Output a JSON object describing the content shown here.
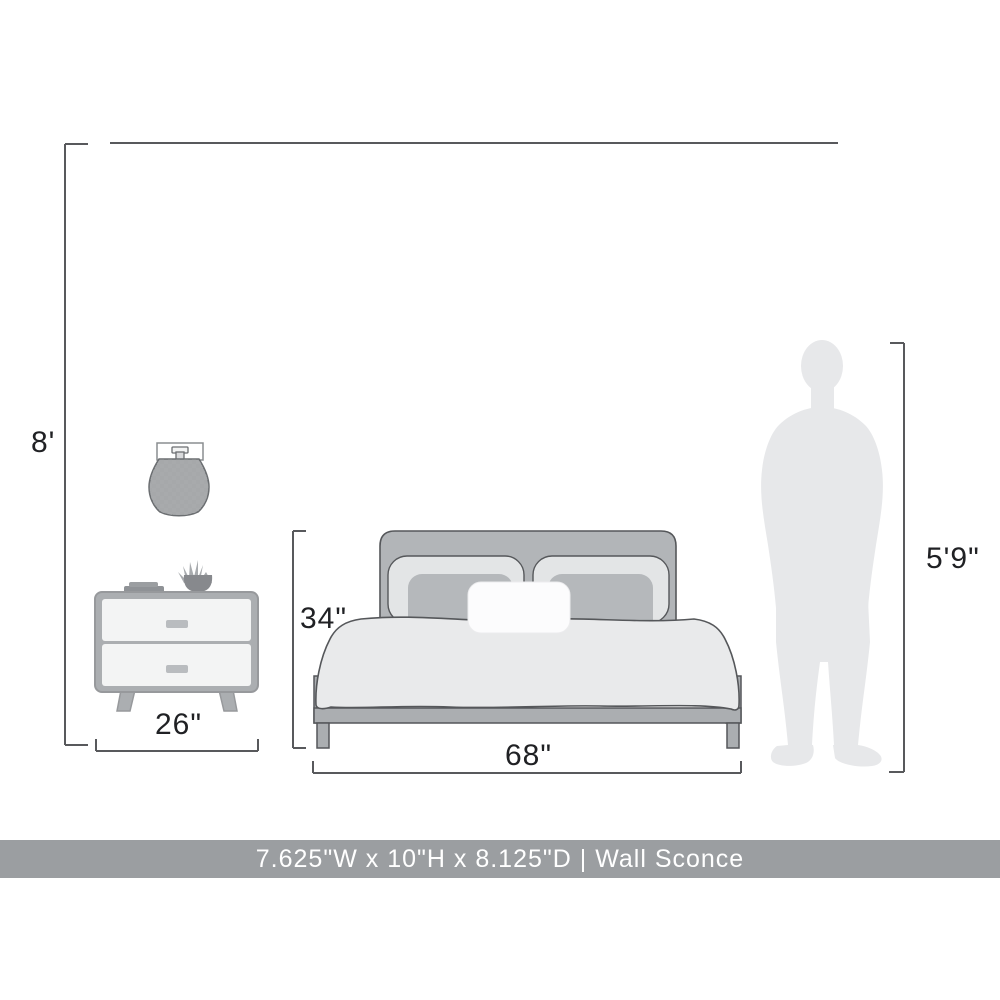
{
  "title": "Furniture scale dimension diagram",
  "labels": {
    "ceiling": "8'",
    "nightstand_width": "26\"",
    "bed_height": "34\"",
    "bed_width": "68\"",
    "person_height": "5'9\""
  },
  "banner": {
    "text": "7.625\"W x 10\"H x 8.125\"D | Wall Sconce"
  },
  "objects": {
    "sconce": "wall sconce with woven barrel shade",
    "nightstand": "two-drawer nightstand with books and potted plant on top",
    "bed": "upholstered platform bed with pillows and duvet",
    "person": "standing man silhouette for scale"
  },
  "colors": {
    "dimension_line": "#58595c",
    "label_text": "#202124",
    "banner_bg": "#9b9ea1",
    "banner_fg": "#ffffff",
    "furniture_gray": "#abaeb1",
    "headboard_gray": "#b2b5b8",
    "drawer_light": "#f3f4f4",
    "pillow_light": "#e3e5e6",
    "lumbar_gray": "#b5b8bb",
    "duvet_light": "#e9eaeb",
    "silhouette_gray": "#e7e8ea",
    "outline_dark": "#55575a"
  }
}
